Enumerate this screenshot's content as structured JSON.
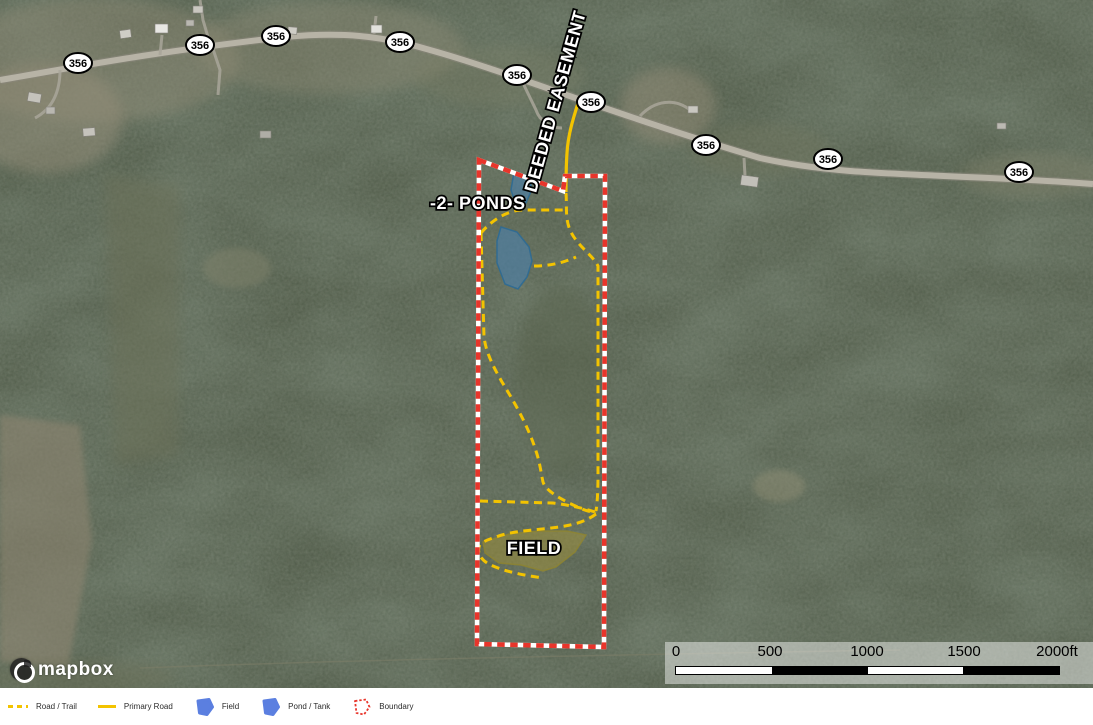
{
  "map": {
    "route_shields": [
      "356",
      "356",
      "356",
      "356",
      "356",
      "356",
      "356",
      "356",
      "356"
    ],
    "labels": {
      "easement": "DEEDED EASEMENT",
      "ponds": "-2- PONDS",
      "field": "FIELD"
    }
  },
  "scalebar": {
    "ticks": [
      "0",
      "500",
      "1000",
      "1500",
      "2000ft"
    ]
  },
  "attribution": {
    "logo_text": "mapbox"
  },
  "legend": {
    "items": [
      {
        "label": "Road / Trail",
        "swatch": "yellow-dashed-line"
      },
      {
        "label": "Primary Road",
        "swatch": "yellow-solid-line"
      },
      {
        "label": "Field",
        "swatch": "blue-polygon"
      },
      {
        "label": "Pond / Tank",
        "swatch": "blue-polygon"
      },
      {
        "label": "Boundary",
        "swatch": "red-dashed-outline"
      }
    ]
  },
  "colors": {
    "trail_yellow": "#F3C300",
    "boundary_red": "#E8352B",
    "pond_fill": "#4C7FA5",
    "field_fill": "#9C8F3C",
    "road_gray": "#B7B3A6",
    "forest_base": "#45503D",
    "legend_blue": "#5B7FE0",
    "scalebar_bg": "rgba(255,255,255,0.45)"
  }
}
